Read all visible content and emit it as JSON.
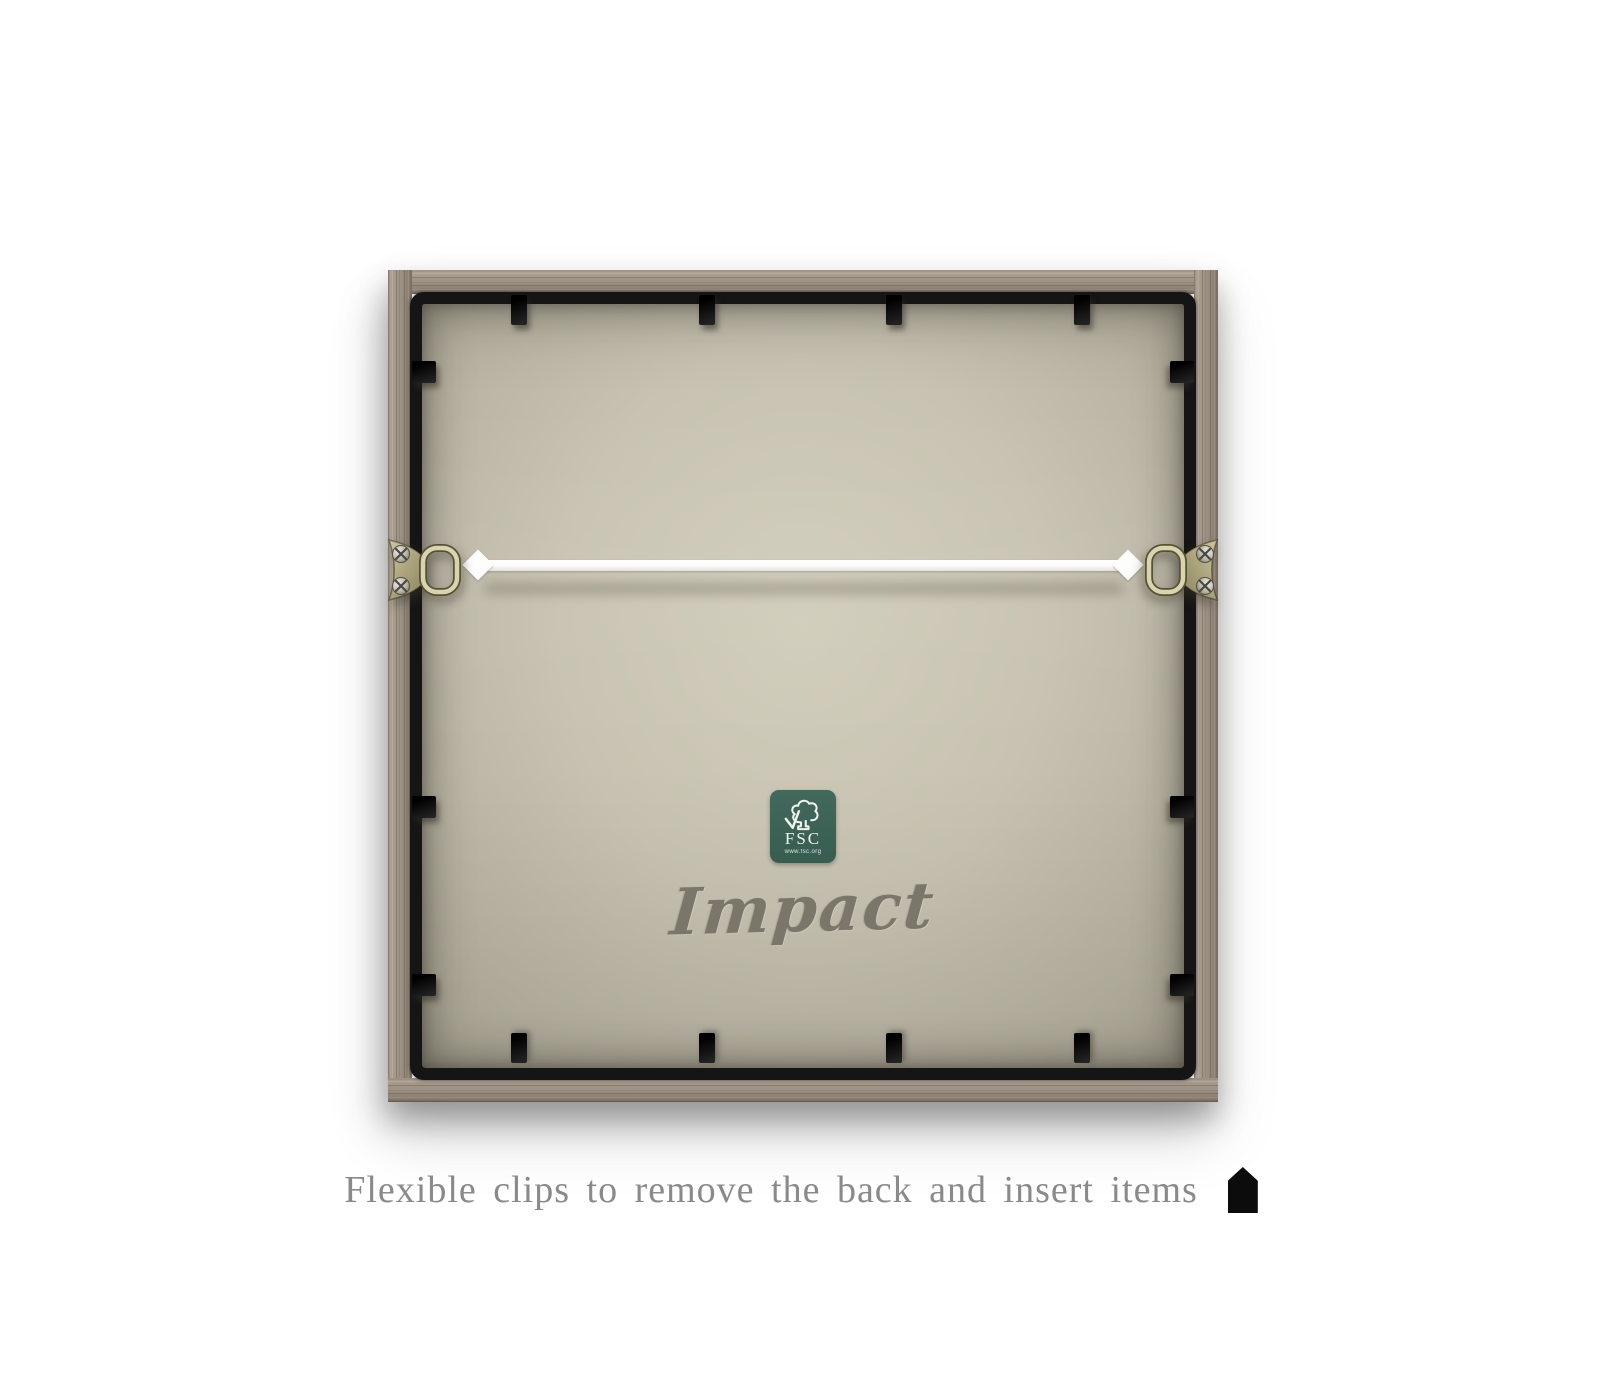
{
  "image_type": "product-photo of picture frame back",
  "frame": {
    "brand_text": "Impact",
    "fsc_label": {
      "acronym": "FSC",
      "url": "www.fsc.org",
      "bg_color": "#3c665a"
    },
    "colors": {
      "wood": "#998e80",
      "metal_inner_frame": "#151515",
      "backing_board": "#c7c2b1",
      "brand_gray": "#7b766a",
      "wire_white": "#fdfdfc"
    }
  },
  "caption": {
    "text": "Flexible clips to remove the back and insert items"
  }
}
